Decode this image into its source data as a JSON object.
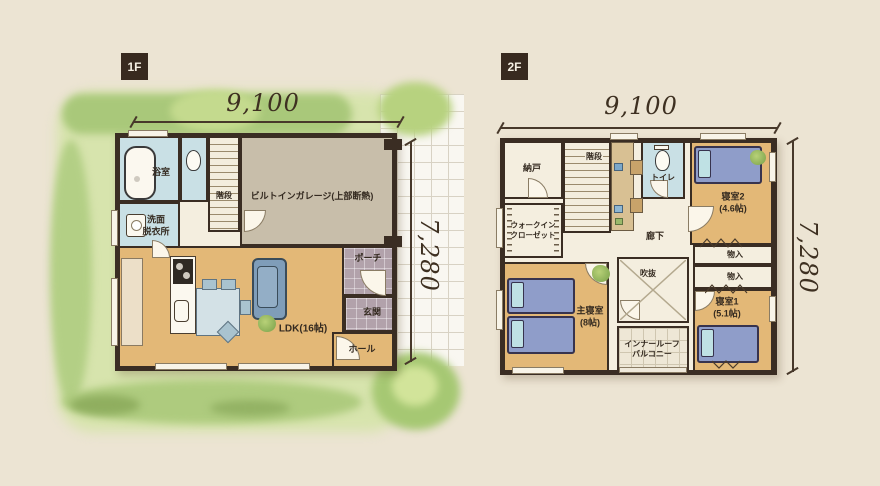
{
  "badges": {
    "f1": "1F",
    "f2": "2F"
  },
  "dimensions": {
    "f1_top": "9,100",
    "f1_side": "7,280",
    "f2_top": "9,100",
    "f2_side": "7,280"
  },
  "floor1": {
    "bath": "浴室",
    "washroom_l1": "洗面",
    "washroom_l2": "脱衣所",
    "stairs": "階段",
    "garage": "ビルトインガレージ(上部断熱)",
    "porch": "ポーチ",
    "entrance": "玄関",
    "hall": "ホール",
    "ldk": "LDK(16帖)"
  },
  "floor2": {
    "storeroom": "納戸",
    "stairs": "階段",
    "toilet": "トイレ",
    "bedroom2": "寝室2",
    "bedroom2_size": "(4.6帖)",
    "wic_l1": "ウォークイン",
    "wic_l2": "クローゼット",
    "hallway": "廊下",
    "closet_a": "物入",
    "closet_b": "物入",
    "master": "主寝室",
    "master_size": "(8帖)",
    "void": "吹抜",
    "balcony_l1": "インナールーフ",
    "balcony_l2": "バルコニー",
    "bedroom1": "寝室1",
    "bedroom1_size": "(5.1帖)"
  },
  "colors": {
    "background": "#ece4d3",
    "wall": "#3a2d23",
    "wood_floor": "#e3b877",
    "wet_room": "#c9e0e5",
    "garage": "#c8beaa",
    "porch_tile": "#b2a2ab",
    "lawn": "#d7e4ad",
    "shrub": "#a9c87a",
    "bed": "#8f9dc9",
    "sofa": "#7f9db9",
    "badge": "#382a1f",
    "dimension_text": "#3e3021"
  }
}
